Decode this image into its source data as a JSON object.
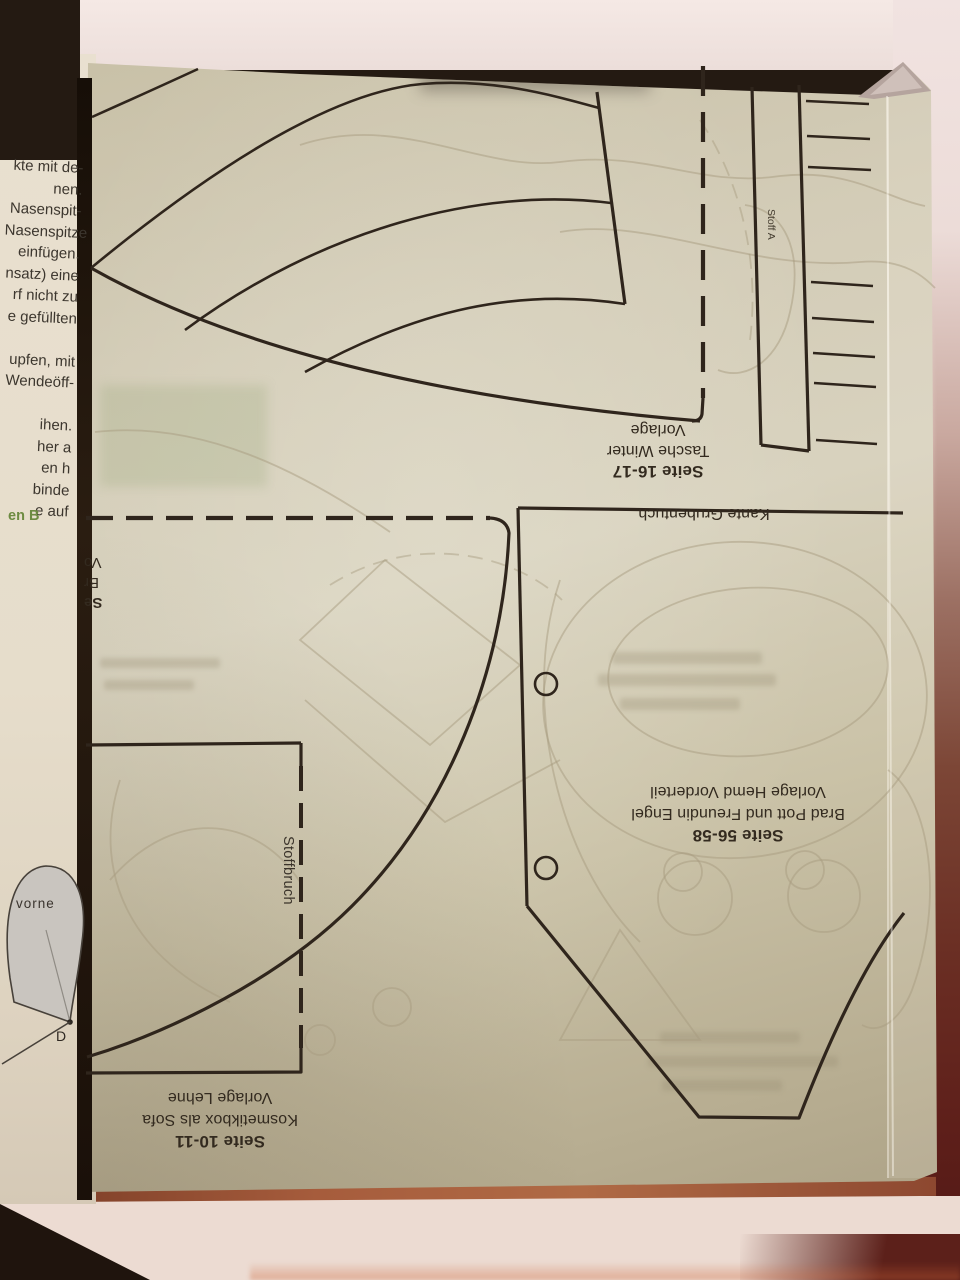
{
  "left_page": {
    "lines": [
      "kte mit de-",
      "nen.",
      "Nasenspit-",
      "Nasenspitze",
      "einfügen.",
      "nsatz) eine",
      "rf nicht zu",
      "e gefüllten",
      "",
      "upfen, mit",
      "Wendeöff-",
      "",
      "ihen.",
      "her a",
      "en h",
      "binde",
      "e auf"
    ],
    "green_line": "en B"
  },
  "labels": {
    "tasche_winter": {
      "line1": "Seite 16-17",
      "line2": "Tasche Winter",
      "line3": "Vorlage"
    },
    "kante_grubentuch": "Kante Grubentuch",
    "hemd": {
      "line1": "Seite 56-58",
      "line2": "Brad Pott und Freundin Engel",
      "line3": "Vorlage Hemd Vorderteil"
    },
    "sofa": {
      "line1": "Seite 10-11",
      "line2": "Kosmetikbox als Sofa",
      "line3": "Vorlage Lehne"
    },
    "partial": {
      "line1": "Se",
      "line2": "Br",
      "line3": "Vo"
    },
    "stoffbruch": "Stoffbruch",
    "stoff_a": "Stoff A",
    "vorne": "vorne",
    "point_d": "D"
  },
  "colors": {
    "ink": "#2f251c",
    "sheet": "#cfc7ad",
    "ghost": "#a79b7f",
    "cream": "#e8dfcf",
    "pink": "#f1e3e1",
    "dark": "#241a12",
    "terra": "#9c5434",
    "cream2": "#ecdbd2",
    "green": "#6d8b41",
    "grey_shape": "#c9c5bf",
    "label": "#332a1f",
    "bodytext": "#3c362e"
  }
}
